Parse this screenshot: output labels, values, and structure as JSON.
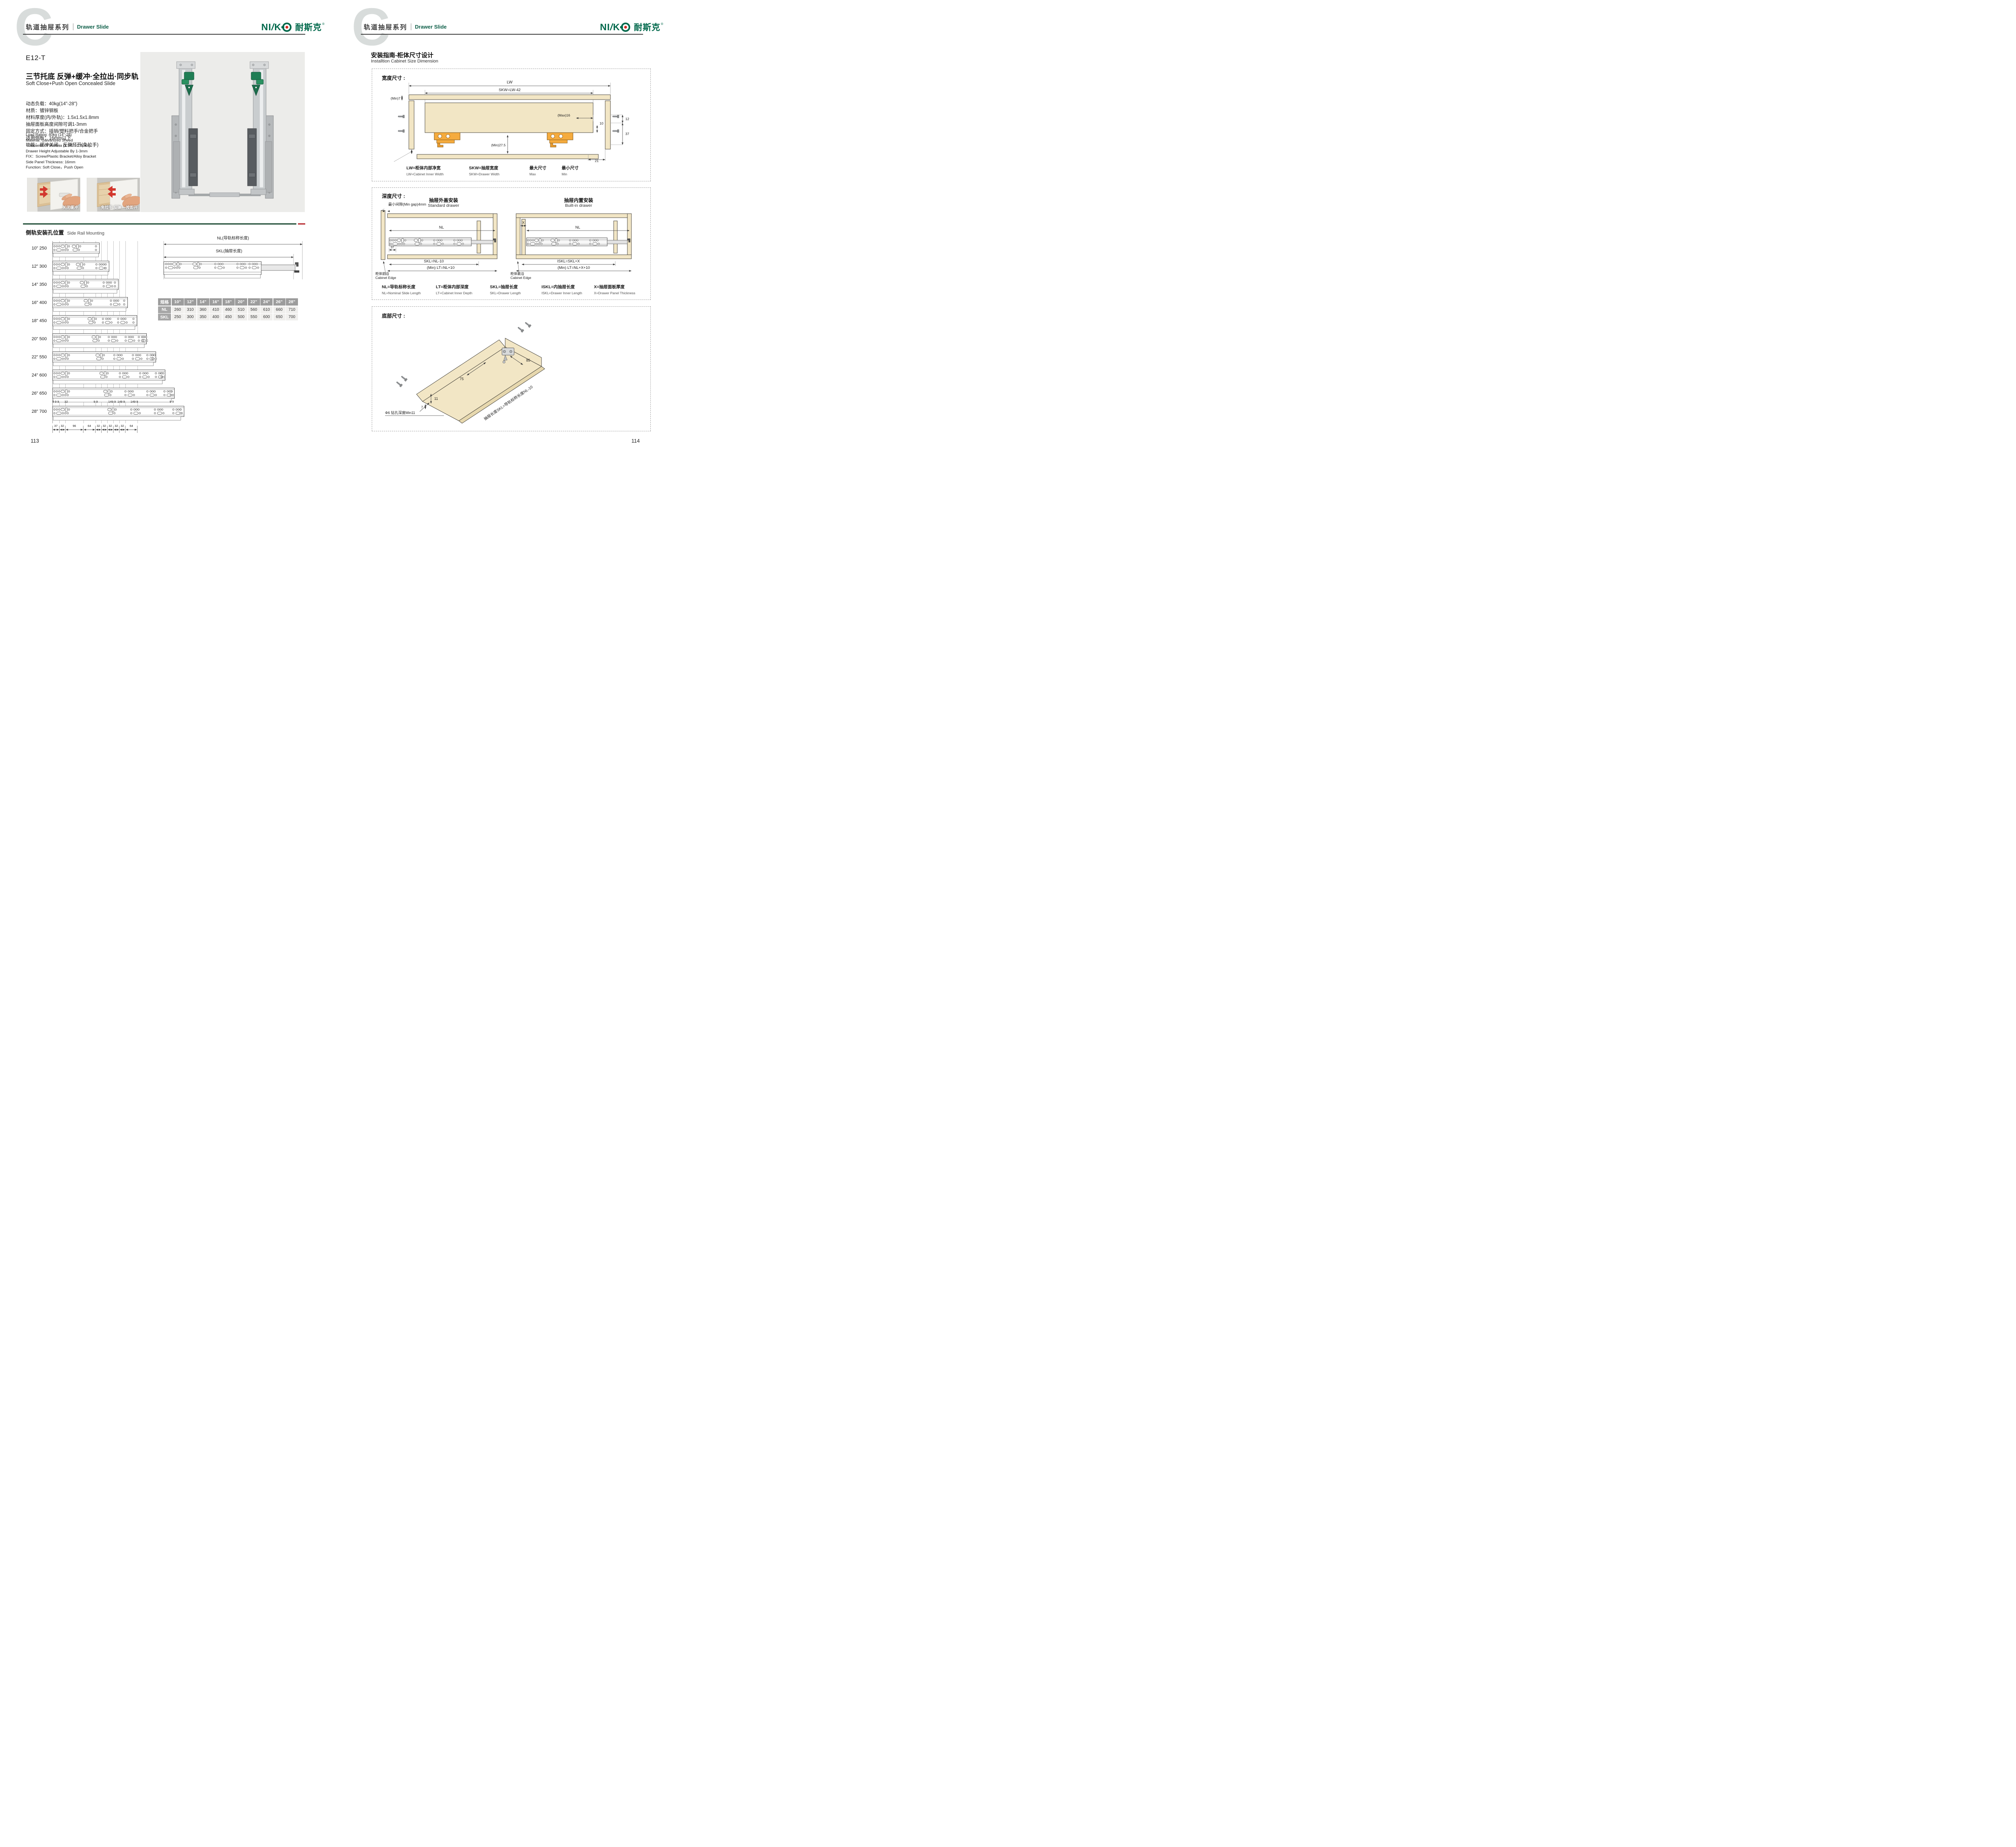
{
  "header": {
    "series_cn": "轨道抽屉系列",
    "series_en": "Drawer Slide",
    "watermark": "C"
  },
  "brand": {
    "latin_left": "NI",
    "latin_slash": "/",
    "latin_k": "K",
    "cn": "耐斯克",
    "reg": "®"
  },
  "left": {
    "model": "E12-T",
    "subtitle_cn": "三节托底 反弹+缓冲·全拉出·同步轨",
    "subtitle_en": "Soft Close+Push Open Concealed Slide",
    "specs_cn": [
      "动态负载：40kg(14\"-28\")",
      "材质：镀锌钢板",
      "材料厚度(内/外轨)：1.5x1.5x1.8mm",
      "抽屉面板高度间隙可调1-3mm",
      "固定方式：插销/塑料把手/合金把手",
      "适用侧板：16mm以下",
      "功能：缓冲关闭，反弹打开(免拉手)"
    ],
    "specs_en": [
      "Load Rating: 40kg (14\"-28)",
      "Material: Galvanized Sheed",
      "Thickness Of Materia (1.5/1.5/1.8mm)",
      "Drawer Height Adjustable By 1-3mm",
      "FIX：Screw/Plastic Bracket/Alloy Bracket",
      "Side Panel Thickness: 16mm",
      "Function: Soft Close，Push Open"
    ],
    "photos": [
      {
        "caption": "关闭缓冲"
      },
      {
        "caption": "免拉手 反弹 一按即开"
      }
    ],
    "section": {
      "cn": "侧轨安装孔位置",
      "en": "Side Rail Mounting"
    },
    "rails": [
      [
        "10\"",
        "250"
      ],
      [
        "12\"",
        "300"
      ],
      [
        "14\"",
        "350"
      ],
      [
        "16\"",
        "400"
      ],
      [
        "18\"",
        "450"
      ],
      [
        "20\"",
        "500"
      ],
      [
        "22\"",
        "550"
      ],
      [
        "24\"",
        "600"
      ],
      [
        "26\"",
        "650"
      ],
      [
        "28\"",
        "700"
      ]
    ],
    "rail_top_dims": [
      "9 9 9",
      "32",
      "9 9",
      "149 9",
      "149 9",
      "149 9",
      "9 9"
    ],
    "rail_bottom_dims": [
      "37",
      "32",
      "96",
      "64",
      "32",
      "32",
      "32",
      "32",
      "32",
      "64"
    ],
    "side_view": {
      "nl": "NL(导轨标称长度)",
      "skl": "SKL(抽屉长度)"
    },
    "table": {
      "spec_label": "规格",
      "cols": [
        "10\"",
        "12\"",
        "14\"",
        "16\"",
        "18\"",
        "20\"",
        "22\"",
        "24\"",
        "26\"",
        "28\""
      ],
      "rows": [
        {
          "label": "NL",
          "values": [
            "260",
            "310",
            "360",
            "410",
            "460",
            "510",
            "560",
            "610",
            "660",
            "710"
          ]
        },
        {
          "label": "SKL",
          "values": [
            "250",
            "300",
            "350",
            "400",
            "450",
            "500",
            "550",
            "600",
            "650",
            "700"
          ]
        }
      ]
    },
    "page_number": "113"
  },
  "right": {
    "title_cn": "安装指南-柜体尺寸设计",
    "title_en": "Installtion Cabinet Size Dimension",
    "width_box": {
      "heading": "宽度尺寸 :",
      "labels": {
        "lw": "LW",
        "skw": "SKW=LW-42",
        "min7": "(Min)7",
        "max16": "(Max)16",
        "d12": "12",
        "d10": "10",
        "d37": "37",
        "min275": "(Min)27.5",
        "min3": "(Min)3",
        "d21": "21"
      },
      "legend": [
        {
          "cn": "LW=柜体内部净宽",
          "en": "LW=Cabinet Inner Width"
        },
        {
          "cn": "SKW=抽屉宽度",
          "en": "SKW=Drawer Width"
        },
        {
          "cn": "最大尺寸",
          "en": "Max"
        },
        {
          "cn": "最小尺寸",
          "en": "Min"
        }
      ]
    },
    "depth_box": {
      "heading": "深度尺寸 :",
      "min_gap": "最小间隙(Min gap)4mm",
      "standard": {
        "title_cn": "抽屉外盖安装",
        "title_en": "Standard drawer",
        "nl": "NL",
        "d37": "37",
        "skl": "SKL=NL-10",
        "lt": "(Min) LT=NL+10",
        "edge_cn": "柜体前沿",
        "edge_en": "Cabinet Edge"
      },
      "builtin": {
        "title_cn": "抽屉内置安装",
        "title_en": "Built-in drawer",
        "x": "X",
        "nl": "NL",
        "iskl": "ISKL=SKL+X",
        "lt": "(Min) LT=NL+X+10",
        "edge_cn": "柜体前沿",
        "edge_en": "Cabinet Edge"
      },
      "legend": [
        {
          "cn": "NL=导轨标称长度",
          "en": "NL=Nominal Slide Length"
        },
        {
          "cn": "LT=柜体内部深度",
          "en": "LT=Cabinet Inner Depth"
        },
        {
          "cn": "SKL=抽屉长度",
          "en": "SKL=Drawer Length"
        },
        {
          "cn": "ISKL=内抽屉长度",
          "en": "ISKL=Drawer Inner Length"
        },
        {
          "cn": "X=抽屉面板厚度",
          "en": "X=Drawer Panel Thickness"
        }
      ]
    },
    "bottom_box": {
      "heading": "底部尺寸 :",
      "d75": "75",
      "d85": "85",
      "d11": "11",
      "d7": "7",
      "drill": "Φ6 钻孔深度Min11",
      "note": "抽屉长度SKL=导轨标称长度NL-10"
    },
    "page_number": "114"
  },
  "colors": {
    "brand_green": "#00684b",
    "accent_red": "#b5242a",
    "rule_green": "#1b4a33",
    "wood": "#f2e6c5",
    "hardware_orange": "#f5ab3d"
  }
}
